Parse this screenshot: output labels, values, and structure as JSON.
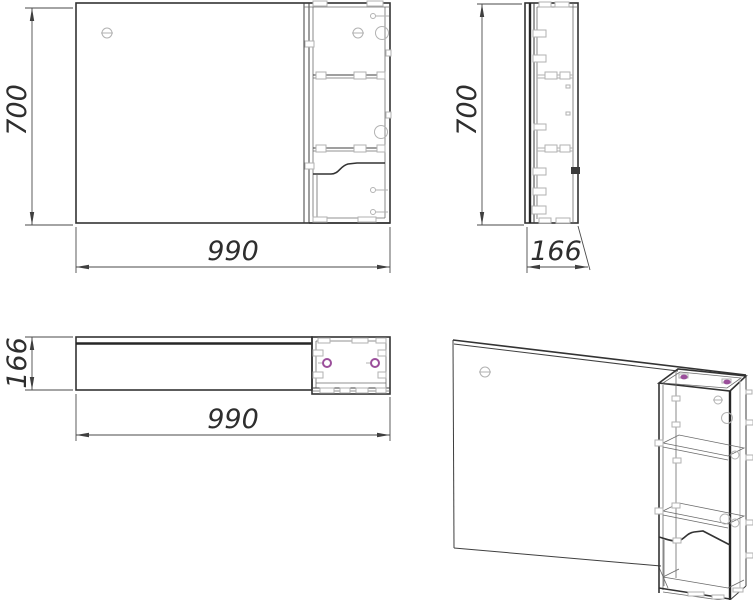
{
  "drawing": {
    "views": {
      "front": {
        "height": "700",
        "width": "990"
      },
      "side": {
        "height": "700",
        "depth": "166"
      },
      "plan": {
        "depth": "166",
        "width": "990"
      }
    },
    "colors": {
      "line": "#3f3f3f",
      "thick_line": "#262626",
      "fitting_line": "#b2b2b2",
      "hinge_accent": "#9b4f9b",
      "background": "#ffffff"
    }
  }
}
